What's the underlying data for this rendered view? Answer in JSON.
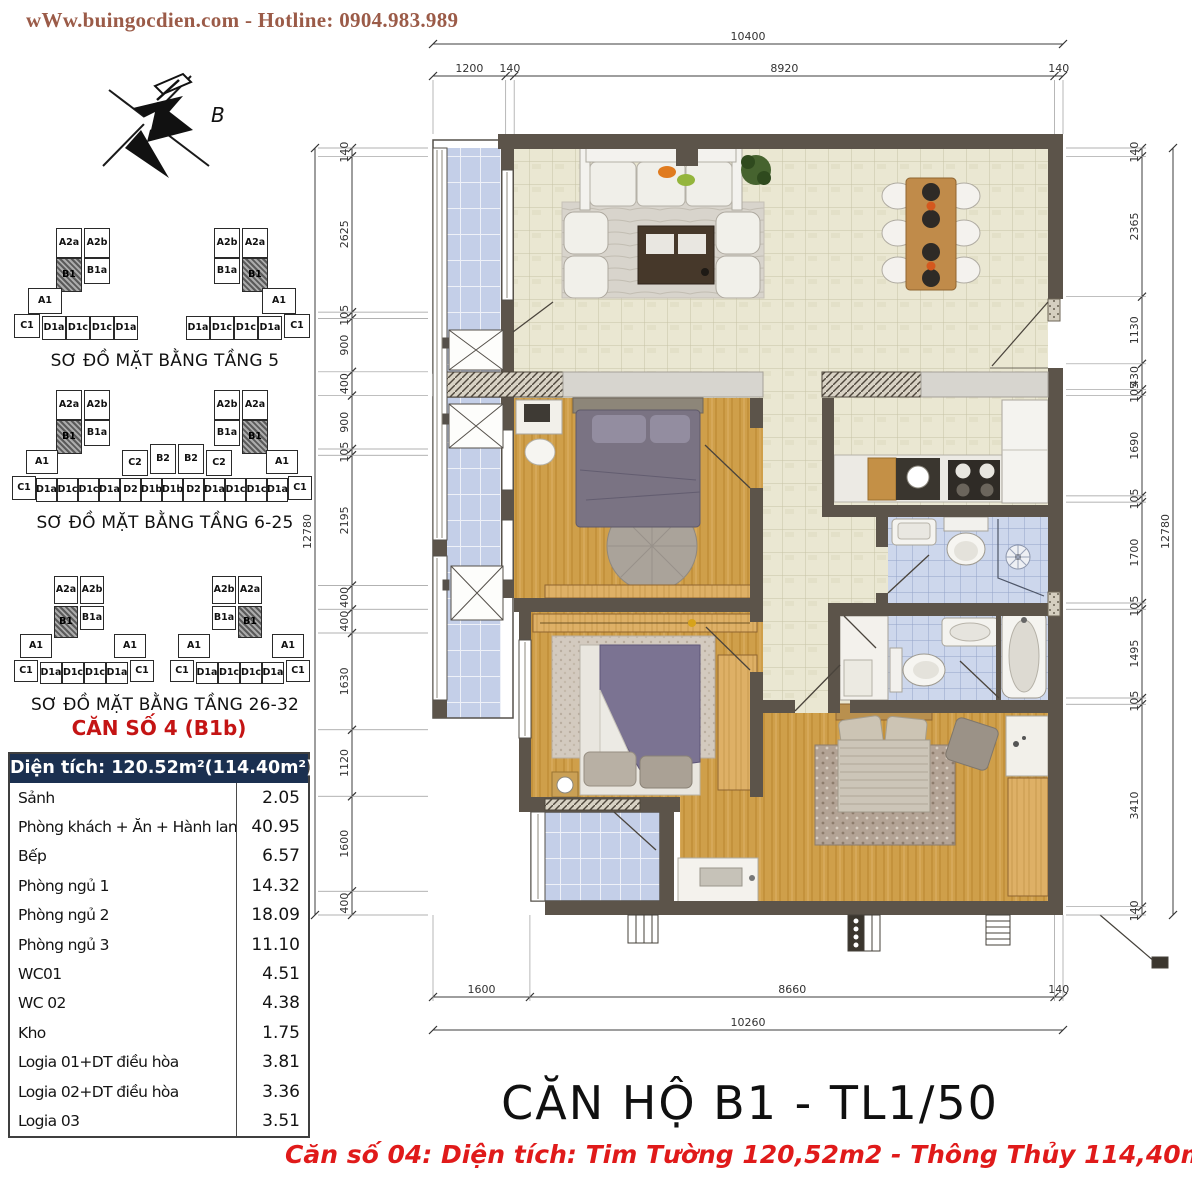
{
  "header": {
    "website_line": "wWw.buingocdien.com  -  Hotline: 0904.983.989"
  },
  "compass": {
    "label": "B"
  },
  "floor_diagrams": [
    {
      "caption": "SƠ ĐỒ MẶT BẰNG TẦNG 5",
      "boxes": [
        [
          "A2a",
          44,
          2,
          26,
          30,
          0
        ],
        [
          "B1",
          44,
          32,
          26,
          34,
          1
        ],
        [
          "A2b",
          72,
          2,
          26,
          30,
          0
        ],
        [
          "B1a",
          72,
          32,
          26,
          26,
          0
        ],
        [
          "A1",
          16,
          62,
          34,
          26,
          0
        ],
        [
          "C1",
          2,
          88,
          26,
          24,
          0
        ],
        [
          "D1a",
          30,
          90,
          24,
          24,
          0
        ],
        [
          "D1c",
          54,
          90,
          24,
          24,
          0
        ],
        [
          "D1c",
          78,
          90,
          24,
          24,
          0
        ],
        [
          "D1a",
          102,
          90,
          24,
          24,
          0
        ],
        [
          "A2b",
          202,
          2,
          26,
          30,
          0
        ],
        [
          "B1a",
          202,
          32,
          26,
          26,
          0
        ],
        [
          "A2a",
          230,
          2,
          26,
          30,
          0
        ],
        [
          "B1",
          230,
          32,
          26,
          34,
          1
        ],
        [
          "A1",
          250,
          62,
          34,
          26,
          0
        ],
        [
          "D1a",
          174,
          90,
          24,
          24,
          0
        ],
        [
          "D1c",
          198,
          90,
          24,
          24,
          0
        ],
        [
          "D1c",
          222,
          90,
          24,
          24,
          0
        ],
        [
          "D1a",
          246,
          90,
          24,
          24,
          0
        ],
        [
          "C1",
          272,
          88,
          26,
          24,
          0
        ]
      ]
    },
    {
      "caption": "SƠ ĐỒ MẶT BẰNG TẦNG 6-25",
      "boxes": [
        [
          "A2a",
          44,
          2,
          26,
          30,
          0
        ],
        [
          "B1",
          44,
          32,
          26,
          34,
          1
        ],
        [
          "A2b",
          72,
          2,
          26,
          30,
          0
        ],
        [
          "B1a",
          72,
          32,
          26,
          26,
          0
        ],
        [
          "A1",
          14,
          62,
          32,
          24,
          0
        ],
        [
          "C2",
          110,
          62,
          26,
          26,
          0
        ],
        [
          "B2",
          138,
          56,
          26,
          30,
          0
        ],
        [
          "B2",
          166,
          56,
          26,
          30,
          0
        ],
        [
          "C2",
          194,
          62,
          26,
          26,
          0
        ],
        [
          "A2b",
          202,
          2,
          26,
          30,
          0
        ],
        [
          "B1a",
          202,
          32,
          26,
          26,
          0
        ],
        [
          "A2a",
          230,
          2,
          26,
          30,
          0
        ],
        [
          "B1",
          230,
          32,
          26,
          34,
          1
        ],
        [
          "A1",
          254,
          62,
          32,
          24,
          0
        ],
        [
          "C1",
          0,
          88,
          24,
          24,
          0
        ],
        [
          "D1a",
          24,
          90,
          21,
          24,
          0
        ],
        [
          "D1c",
          45,
          90,
          21,
          24,
          0
        ],
        [
          "D1c",
          66,
          90,
          21,
          24,
          0
        ],
        [
          "D1a",
          87,
          90,
          21,
          24,
          0
        ],
        [
          "D2",
          108,
          90,
          21,
          24,
          0
        ],
        [
          "D1b",
          129,
          90,
          21,
          24,
          0
        ],
        [
          "D1b",
          150,
          90,
          21,
          24,
          0
        ],
        [
          "D2",
          171,
          90,
          21,
          24,
          0
        ],
        [
          "D1a",
          192,
          90,
          21,
          24,
          0
        ],
        [
          "D1c",
          213,
          90,
          21,
          24,
          0
        ],
        [
          "D1c",
          234,
          90,
          21,
          24,
          0
        ],
        [
          "D1a",
          255,
          90,
          21,
          24,
          0
        ],
        [
          "C1",
          276,
          88,
          24,
          24,
          0
        ]
      ]
    },
    {
      "caption": "SƠ ĐỒ MẶT BẰNG TẦNG 26-32",
      "boxes": [
        [
          "A2a",
          42,
          0,
          24,
          28,
          0
        ],
        [
          "B1",
          42,
          30,
          24,
          32,
          1
        ],
        [
          "A2b",
          68,
          0,
          24,
          28,
          0
        ],
        [
          "B1a",
          68,
          30,
          24,
          24,
          0
        ],
        [
          "A1",
          8,
          58,
          32,
          24,
          0
        ],
        [
          "A1",
          102,
          58,
          32,
          24,
          0
        ],
        [
          "C1",
          2,
          84,
          24,
          22,
          0
        ],
        [
          "D1a",
          28,
          86,
          22,
          22,
          0
        ],
        [
          "D1c",
          50,
          86,
          22,
          22,
          0
        ],
        [
          "D1c",
          72,
          86,
          22,
          22,
          0
        ],
        [
          "D1a",
          94,
          86,
          22,
          22,
          0
        ],
        [
          "C1",
          118,
          84,
          24,
          22,
          0
        ],
        [
          "A2b",
          200,
          0,
          24,
          28,
          0
        ],
        [
          "B1a",
          200,
          30,
          24,
          24,
          0
        ],
        [
          "A2a",
          226,
          0,
          24,
          28,
          0
        ],
        [
          "B1",
          226,
          30,
          24,
          32,
          1
        ],
        [
          "A1",
          166,
          58,
          32,
          24,
          0
        ],
        [
          "A1",
          260,
          58,
          32,
          24,
          0
        ],
        [
          "C1",
          158,
          84,
          24,
          22,
          0
        ],
        [
          "D1a",
          184,
          86,
          22,
          22,
          0
        ],
        [
          "D1c",
          206,
          86,
          22,
          22,
          0
        ],
        [
          "D1c",
          228,
          86,
          22,
          22,
          0
        ],
        [
          "D1a",
          250,
          86,
          22,
          22,
          0
        ],
        [
          "C1",
          274,
          84,
          24,
          22,
          0
        ]
      ]
    }
  ],
  "unit_title": "CĂN SỐ 4 (B1b)",
  "area_table": {
    "header": "Diện tích: 120.52m²(114.40m²)",
    "rows": [
      [
        "Sảnh",
        "2.05"
      ],
      [
        "Phòng khách + Ăn + Hành lang",
        "40.95"
      ],
      [
        "Bếp",
        "6.57"
      ],
      [
        "Phòng ngủ 1",
        "14.32"
      ],
      [
        "Phòng ngủ 2",
        "18.09"
      ],
      [
        "Phòng ngủ 3",
        "11.10"
      ],
      [
        "WC01",
        "4.51"
      ],
      [
        "WC 02",
        "4.38"
      ],
      [
        "Kho",
        "1.75"
      ],
      [
        "Logia 01+DT điều hòa",
        "3.81"
      ],
      [
        "Logia 02+DT điều hòa",
        "3.36"
      ],
      [
        "Logia 03",
        "3.51"
      ]
    ]
  },
  "plan": {
    "dimensions": {
      "top_total": "10400",
      "top_segments": [
        "1200",
        "140",
        "8920",
        "140"
      ],
      "left_total": "12780",
      "left_segments": [
        "140",
        "2625",
        "105",
        "900",
        "400",
        "900",
        "105",
        "2195",
        "400",
        "400",
        "1630",
        "1120",
        "1600",
        "400"
      ],
      "right_total": "12780",
      "right_segments": [
        "140",
        "2365",
        "1130",
        "430",
        "105",
        "1690",
        "105",
        "1700",
        "105",
        "1495",
        "105",
        "3410",
        "140"
      ],
      "bottom_segments": [
        "1600",
        "8660",
        "140"
      ],
      "bottom_total": "10260"
    }
  },
  "footer": {
    "title": "CĂN HỘ B1 - TL1/50",
    "subtitle": "Căn số 04: Diện tích: Tim Tường 120,52m2 - Thông Thủy 114,40m2"
  },
  "colors": {
    "header_text": "#9b5b48",
    "table_header_bg": "#1b3050",
    "red_accent": "#e01a1a",
    "unit_title_red": "#c41414",
    "wall": "#5c544a",
    "tile_floor": "#eae7d2",
    "wood_floor": "#cf9f4a",
    "wc_tile": "#cdd7ec",
    "logia_glass": "#c4cfe8"
  }
}
